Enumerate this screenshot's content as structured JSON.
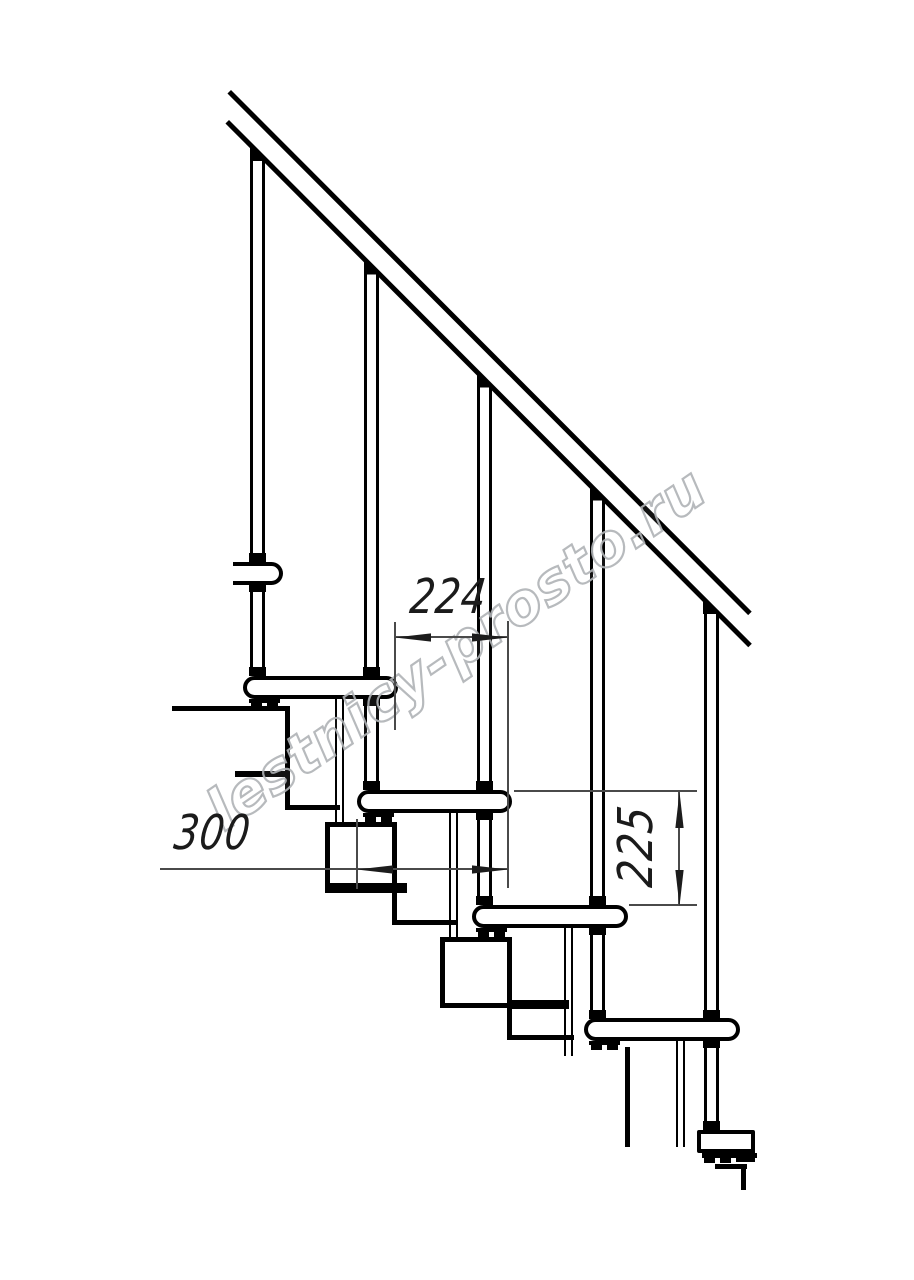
{
  "drawing": {
    "watermark_text": "lestnicy-prosto.ru",
    "dimensions": {
      "step_run": "224",
      "tread_depth": "300",
      "riser_height": "225"
    },
    "colors": {
      "structure_line": "#000000",
      "dimension_line": "#4a4a4a",
      "dimension_text": "#1b1b1b",
      "watermark": "#b0b3b6",
      "background": "#ffffff"
    },
    "structure": {
      "balusters": 5,
      "full_steps": 4,
      "partial_steps": 2,
      "handrail_lines": 2,
      "module_boxes": 3
    }
  }
}
